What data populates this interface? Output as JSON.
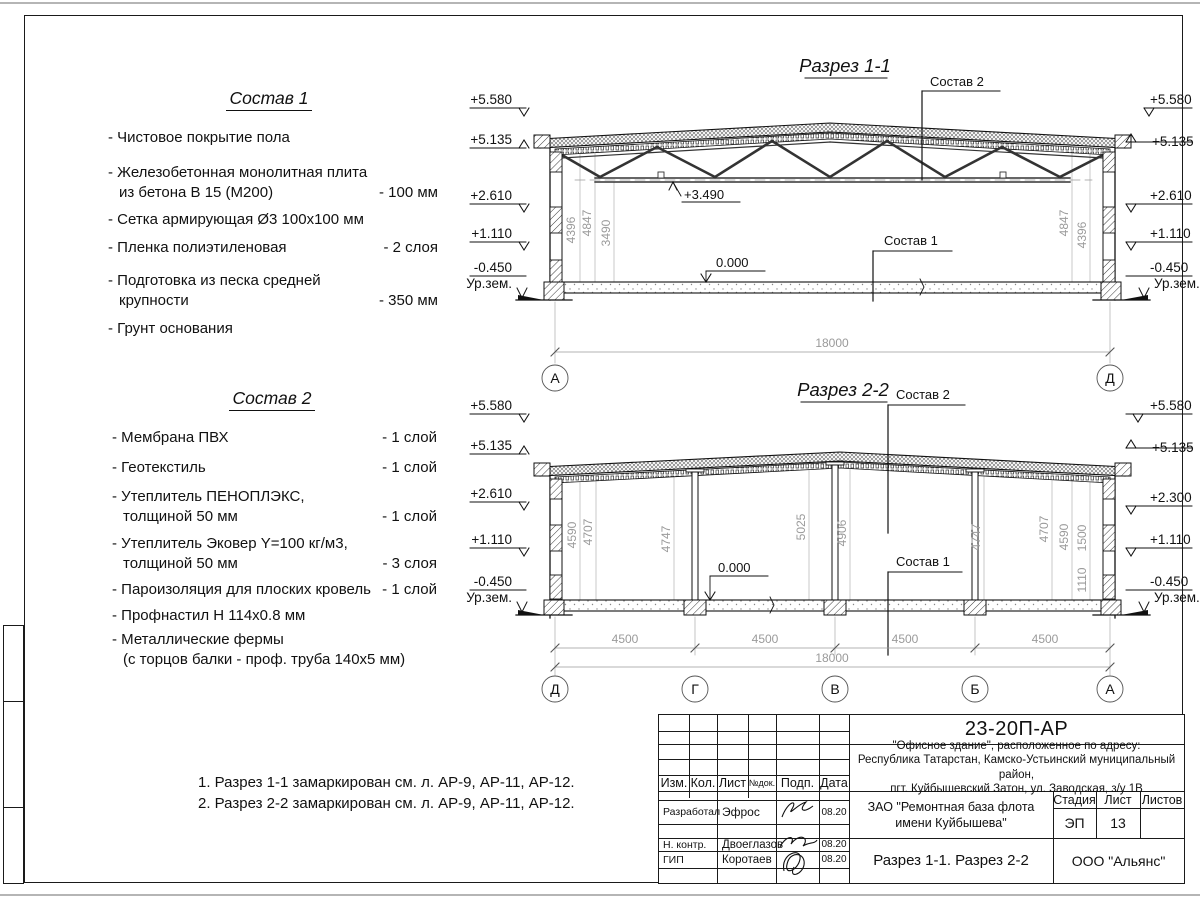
{
  "sostav1": {
    "title": "Состав 1",
    "items": [
      {
        "name": "- Чистовое покрытие пола",
        "name2": "",
        "qty": ""
      },
      {
        "name": "- Железобетонная  монолитная плита",
        "name2": "из бетона В 15 (М200)",
        "qty": "- 100 мм"
      },
      {
        "name": "- Сетка армирующая Ø3 100х100 мм",
        "name2": "",
        "qty": ""
      },
      {
        "name": "- Пленка полиэтиленовая",
        "name2": "",
        "qty": "-  2 слоя"
      },
      {
        "name": "- Подготовка из песка средней",
        "name2": "крупности",
        "qty": "- 350 мм"
      },
      {
        "name": "- Грунт основания",
        "name2": "",
        "qty": ""
      }
    ]
  },
  "sostav2": {
    "title": "Состав 2",
    "items": [
      {
        "name": "- Мембрана ПВХ",
        "name2": "",
        "qty": "- 1 слой"
      },
      {
        "name": "- Геотекстиль",
        "name2": "",
        "qty": "- 1 слой"
      },
      {
        "name": "- Утеплитель ПЕНОПЛЭКС,",
        "name2": "толщиной 50 мм",
        "qty": "- 1 слой"
      },
      {
        "name": "- Утеплитель Эковер Y=100 кг/м3,",
        "name2": "толщиной 50 мм",
        "qty": "- 3 слоя"
      },
      {
        "name": "- Пароизоляция для плоских кровель",
        "name2": "",
        "qty": "- 1 слой"
      },
      {
        "name": "- Профнастил Н 114х0.8 мм",
        "name2": "",
        "qty": ""
      },
      {
        "name": "- Металлические фермы",
        "name2": "(с торцов балки - проф. труба 140х5 мм)",
        "qty": ""
      }
    ]
  },
  "notes": [
    "1. Разрез 1-1 замаркирован см. л. АР-9, АР-11, АР-12.",
    "2. Разрез 2-2 замаркирован см. л. АР-9, АР-11, АР-12."
  ],
  "section1": {
    "title": "Разрез 1-1",
    "levels_left": [
      "+5.580",
      "+5.135",
      "+2.610",
      "+1.110",
      "-0.450"
    ],
    "levels_right": [
      "+5.580",
      "+5.135",
      "+2.610",
      "+1.110",
      "-0.450"
    ],
    "ground": "Ур.зем.",
    "lvl_truss": "+3.490",
    "lvl_floor": "0.000",
    "dims_left": [
      "4396",
      "4847",
      "3490"
    ],
    "dims_right": [
      "4847",
      "4396"
    ],
    "span": "18000",
    "axis_left": "А",
    "axis_right": "Д",
    "label_roof": "Состав 2",
    "label_floor": "Состав 1"
  },
  "section2": {
    "title": "Разрез 2-2",
    "levels_left": [
      "+5.580",
      "+5.135",
      "+2.610",
      "+1.110",
      "-0.450"
    ],
    "levels_right": [
      "+5.580",
      "+5.135",
      "+2.300",
      "+1.110",
      "-0.450"
    ],
    "ground": "Ур.зем.",
    "lvl_floor": "0.000",
    "vdims": [
      "4590",
      "4707",
      "4747",
      "5025",
      "4906",
      "4747",
      "4707",
      "4590",
      "1500",
      "1110"
    ],
    "bays": [
      "4500",
      "4500",
      "4500",
      "4500"
    ],
    "span": "18000",
    "axes": [
      "Д",
      "Г",
      "В",
      "Б",
      "А"
    ],
    "label_roof": "Состав 2",
    "label_floor": "Состав 1"
  },
  "titleblock": {
    "code": "23-20П-АР",
    "object1": "\"Офисное здание\", расположенное по адресу:",
    "object2": "Республика Татарстан, Камско-Устьинский муниципальный район,",
    "object3": "пгт. Куйбышевский Затон, ул. Заводская, з/у 1В",
    "client1": "ЗАО \"Ремонтная база флота",
    "client2": "имени Куйбышева\"",
    "doc_title": "Разрез 1-1. Разрез 2-2",
    "company": "ООО \"Альянс\"",
    "stage_label": "Стадия",
    "sheet_label": "Лист",
    "sheets_label": "Листов",
    "stage": "ЭП",
    "sheet_no": "13",
    "cols": [
      "Изм.",
      "Кол.",
      "Лист",
      "№док.",
      "Подп.",
      "Дата"
    ],
    "rows": [
      {
        "role": "Разработал",
        "name": "Эфрос",
        "date": "08.20"
      },
      {
        "role": "Н. контр.",
        "name": "Двоеглазов",
        "date": "08.20"
      },
      {
        "role": "ГИП",
        "name": "Коротаев",
        "date": "08.20"
      }
    ]
  }
}
